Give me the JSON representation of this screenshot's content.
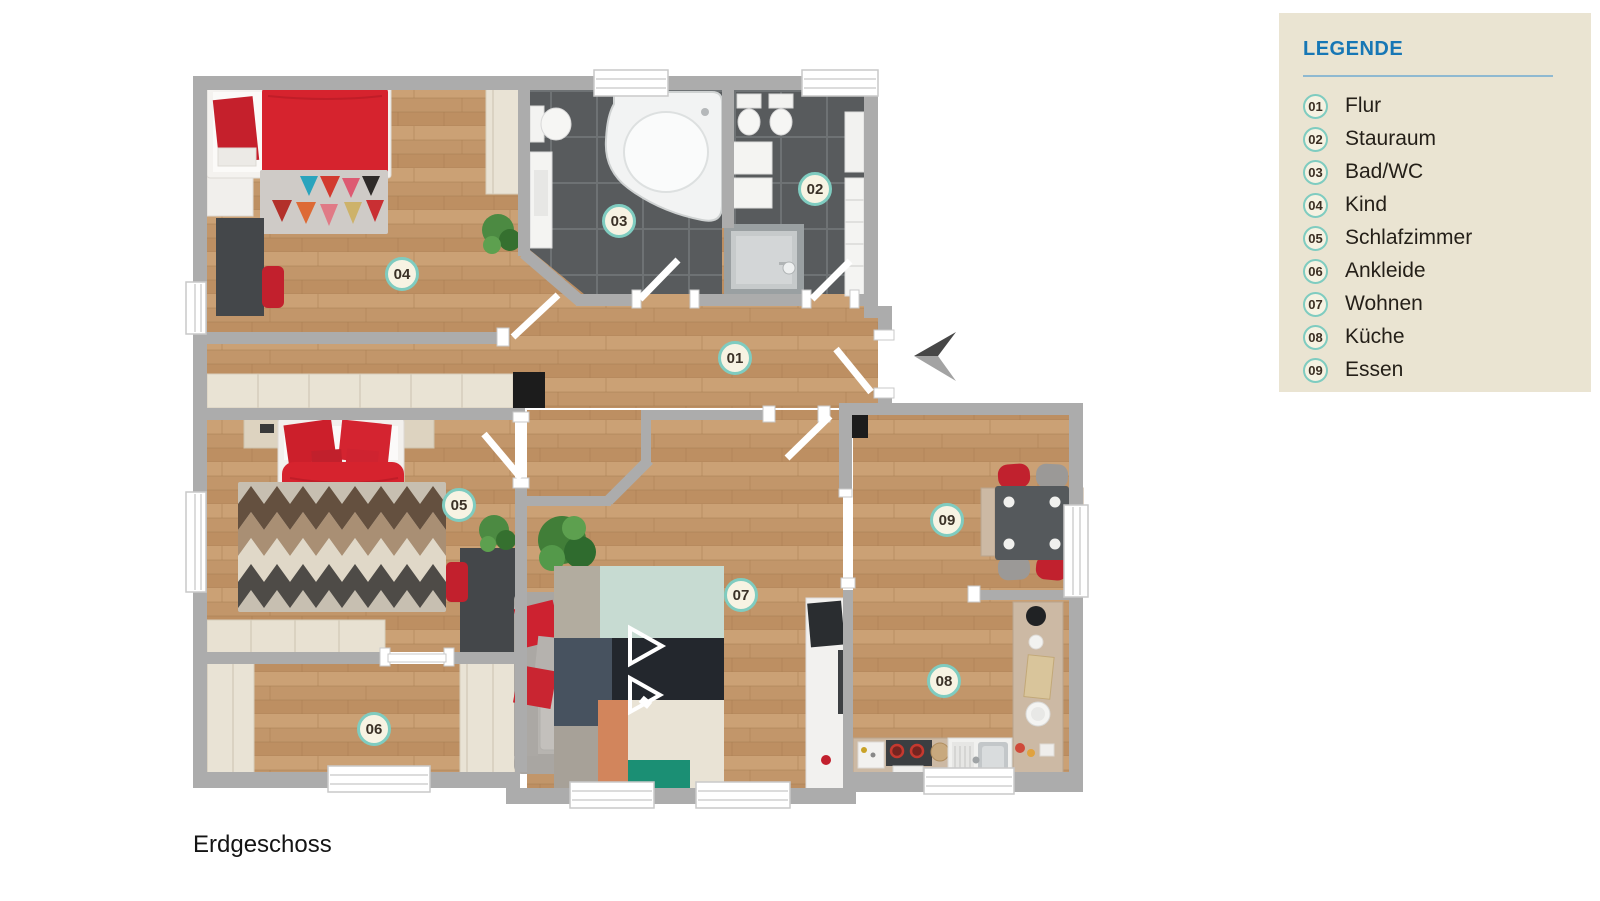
{
  "floor_label": "Erdgeschoss",
  "legend": {
    "title": "LEGENDE",
    "items": [
      {
        "id": "01",
        "name": "Flur"
      },
      {
        "id": "02",
        "name": "Stauraum"
      },
      {
        "id": "03",
        "name": "Bad/WC"
      },
      {
        "id": "04",
        "name": "Kind"
      },
      {
        "id": "05",
        "name": "Schlafzimmer"
      },
      {
        "id": "06",
        "name": "Ankleide"
      },
      {
        "id": "07",
        "name": "Wohnen"
      },
      {
        "id": "08",
        "name": "Küche"
      },
      {
        "id": "09",
        "name": "Essen"
      }
    ]
  },
  "colors": {
    "legend_bg": "#eae4d2",
    "legend_accent": "#1777b5",
    "marker_ring": "#7fccc0",
    "marker_bg": "#f7f3e3",
    "wall": "#acacac",
    "wood_floor": "#c69b6e",
    "bath_tile": "#585b5d",
    "accent_red": "#d6232e"
  },
  "icons": {
    "entrance_arrow": "entrance-direction-arrow"
  }
}
